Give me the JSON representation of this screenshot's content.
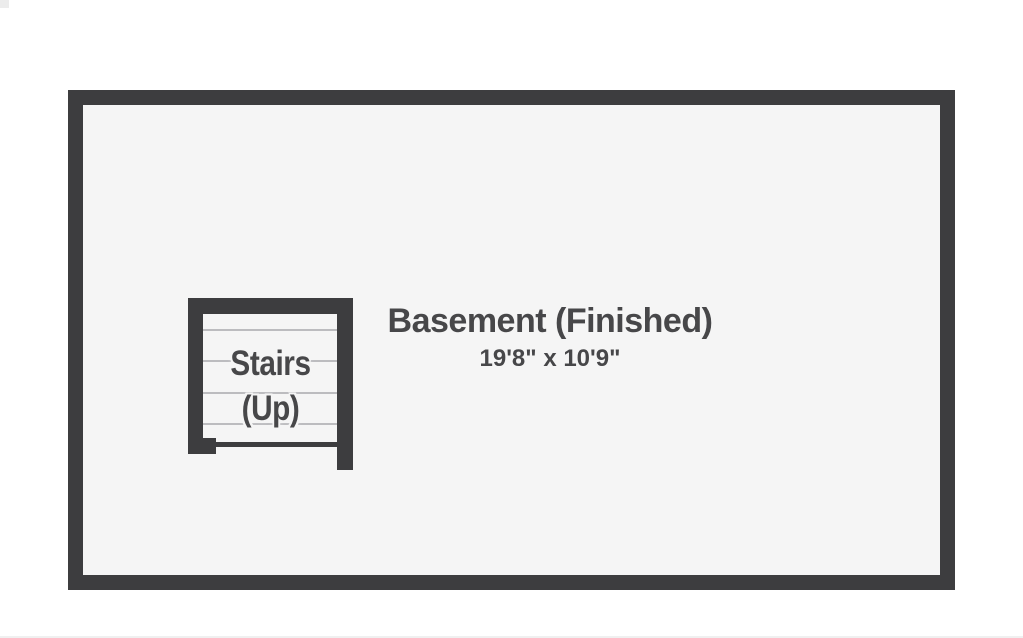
{
  "floorplan": {
    "room": {
      "name": "Basement (Finished)",
      "dimensions": "19'8\" x 10'9\""
    },
    "stairs": {
      "label": "Stairs",
      "direction": "(Up)",
      "tread_count": 4
    }
  },
  "colors": {
    "wall": "#3d3d3f",
    "floor": "#f5f5f5",
    "background": "#ffffff",
    "tread_line": "#bcbcbf",
    "text": "#474749"
  }
}
